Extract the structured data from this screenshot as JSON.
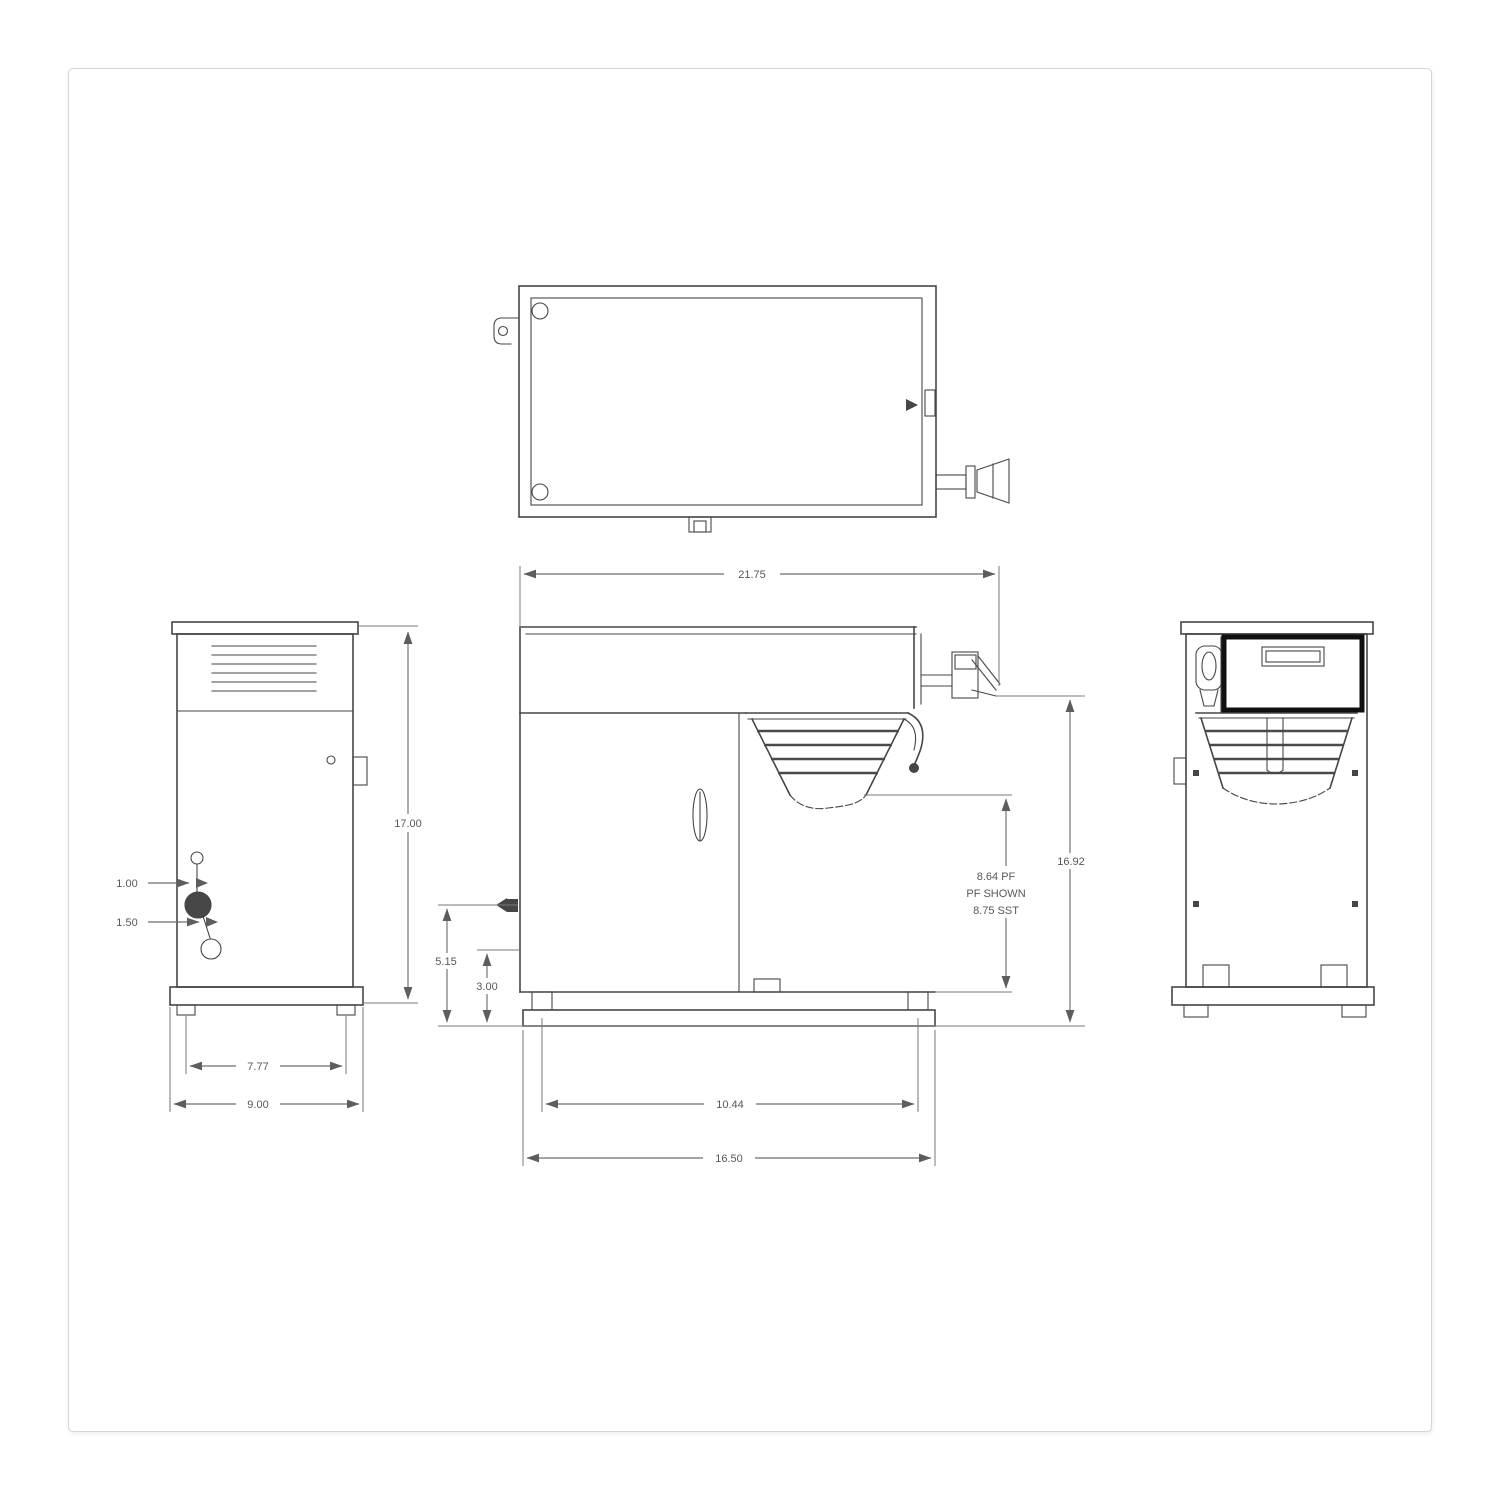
{
  "colors": {
    "line": "#464646",
    "dimension_line": "#6e6e6e",
    "label_text": "#585858",
    "panel_border": "#101010",
    "sheet_background": "#ffffff",
    "sheet_border": "#d2d5d9"
  },
  "dimensions": {
    "top_width": "21.75",
    "side_height": "17.00",
    "fitting_offset_top": "1.00",
    "fitting_offset_bottom": "1.50",
    "side_feet_spacing": "7.77",
    "side_base_depth": "9.00",
    "inlet_height": "5.15",
    "lower_clearance": "3.00",
    "front_feet_spacing": "10.44",
    "front_base_width": "16.50",
    "overall_height": "16.92",
    "funnel_clearance_line1": "8.64 PF",
    "funnel_clearance_line2": "PF SHOWN",
    "funnel_clearance_line3": "8.75 SST"
  }
}
